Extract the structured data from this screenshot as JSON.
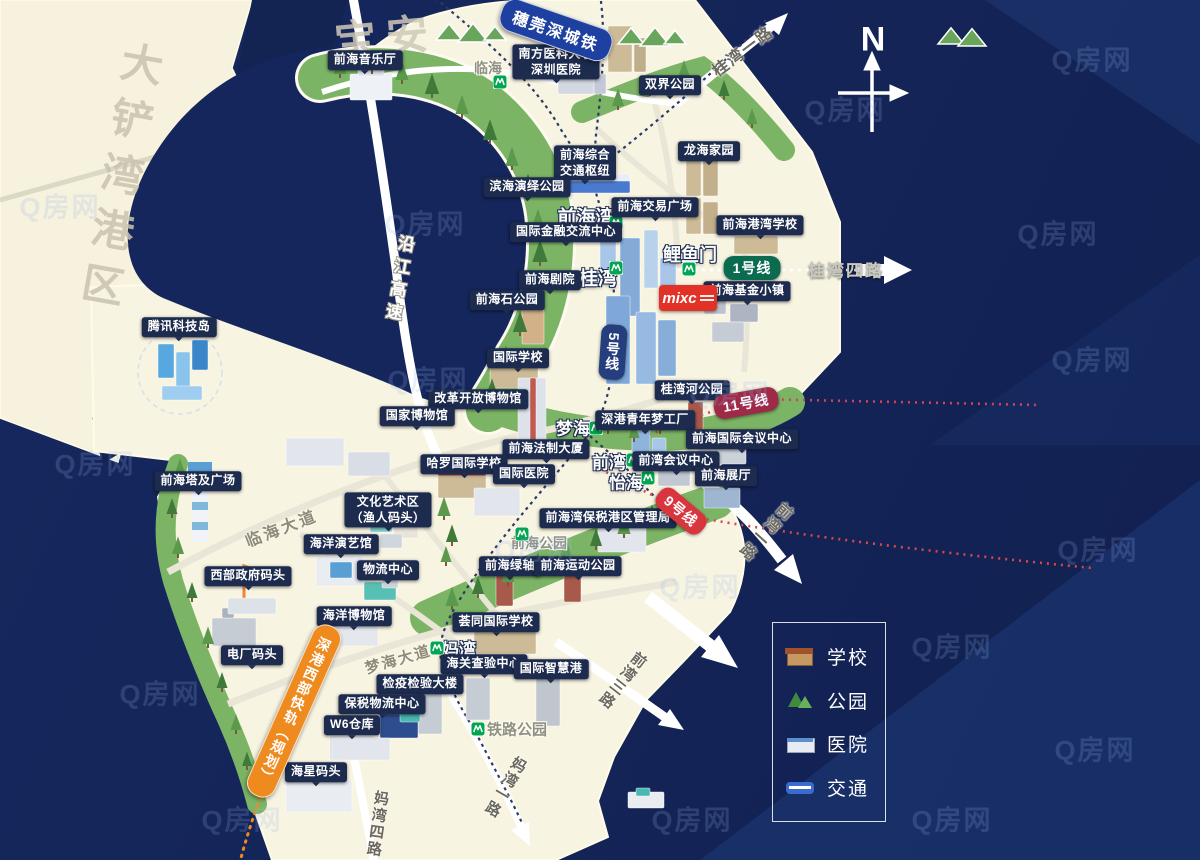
{
  "watermark": {
    "text": "Q房网",
    "positions": [
      [
        60,
        205
      ],
      [
        425,
        222
      ],
      [
        845,
        108
      ],
      [
        1092,
        58
      ],
      [
        1058,
        232
      ],
      [
        428,
        378
      ],
      [
        95,
        462
      ],
      [
        730,
        392
      ],
      [
        1092,
        358
      ],
      [
        535,
        548
      ],
      [
        1098,
        548
      ],
      [
        160,
        692
      ],
      [
        700,
        585
      ],
      [
        952,
        645
      ],
      [
        242,
        818
      ],
      [
        692,
        818
      ],
      [
        952,
        818
      ],
      [
        1095,
        748
      ]
    ]
  },
  "compass": {
    "label": "N"
  },
  "ghosts": [
    {
      "name": "ghost-dachanwan-port",
      "text": "大铲湾港区",
      "x": 112,
      "y": 168,
      "vertical": true,
      "rot": 10,
      "size": 42,
      "ls": 14,
      "color": "#c9c3b0"
    },
    {
      "name": "ghost-baoan",
      "text": "宝安",
      "x": 380,
      "y": 25,
      "vertical": false,
      "rot": -5,
      "size": 42,
      "ls": 10,
      "color": "#cfc9b8"
    }
  ],
  "banners": [
    {
      "name": "intercity-rail-banner",
      "text": "穗莞深城铁",
      "x": 556,
      "y": 30,
      "rot": 19,
      "color": "#1e40a0",
      "vertical": false,
      "size": 16
    },
    {
      "name": "west-express-rail-banner",
      "text": "深港西部快轨（规划）",
      "x": 294,
      "y": 711,
      "rot": 24,
      "color": "#ef8a1f",
      "vertical": true,
      "size": 14
    }
  ],
  "metro_lines": [
    {
      "name": "metro-line-1-badge",
      "label": "1号线",
      "x": 752,
      "y": 268,
      "color": "#0a6b50",
      "rot": 0,
      "vertical": false
    },
    {
      "name": "metro-line-5-badge",
      "label": "5号线",
      "x": 613,
      "y": 352,
      "color": "#253f7e",
      "rot": 4,
      "vertical": true
    },
    {
      "name": "metro-line-11-badge",
      "label": "11号线",
      "x": 746,
      "y": 403,
      "color": "#9e2a47",
      "rot": -10,
      "vertical": false
    },
    {
      "name": "metro-line-9-badge",
      "label": "9号线",
      "x": 681,
      "y": 511,
      "color": "#d9353f",
      "rot": 40,
      "vertical": false
    }
  ],
  "roads": [
    {
      "name": "road-yanjiang-expressway",
      "text": "沿江高速",
      "x": 398,
      "y": 280,
      "vertical": true,
      "rot": 10,
      "cls": "white-outline",
      "size": 17,
      "ls": 6
    },
    {
      "name": "road-guiwan-1",
      "text": "桂湾一路",
      "x": 742,
      "y": 50,
      "vertical": false,
      "rot": -37,
      "cls": "dark",
      "size": 16,
      "ls": 2
    },
    {
      "name": "road-guiwan-4",
      "text": "桂湾四路",
      "x": 846,
      "y": 269,
      "vertical": false,
      "rot": 0,
      "cls": "light",
      "size": 17,
      "ls": 2
    },
    {
      "name": "road-qianwan-1",
      "text": "前湾一路",
      "x": 764,
      "y": 530,
      "vertical": true,
      "rot": 42,
      "cls": "dark",
      "size": 16,
      "ls": 2
    },
    {
      "name": "road-qianwan-3",
      "text": "前湾三路",
      "x": 622,
      "y": 680,
      "vertical": true,
      "rot": 38,
      "cls": "dark",
      "size": 15,
      "ls": 2
    },
    {
      "name": "road-linhai-avenue",
      "text": "临海大道",
      "x": 281,
      "y": 527,
      "vertical": false,
      "rot": -21,
      "cls": "gray",
      "size": 16,
      "ls": 3
    },
    {
      "name": "road-menghai-avenue",
      "text": "梦海大道",
      "x": 398,
      "y": 659,
      "vertical": false,
      "rot": -16,
      "cls": "gray",
      "size": 15,
      "ls": 2
    },
    {
      "name": "road-mawan-1",
      "text": "妈湾一路",
      "x": 505,
      "y": 787,
      "vertical": true,
      "rot": 30,
      "cls": "dark",
      "size": 15,
      "ls": 2
    },
    {
      "name": "road-mawan-4",
      "text": "妈湾四路",
      "x": 377,
      "y": 824,
      "vertical": true,
      "rot": 8,
      "cls": "dark",
      "size": 15,
      "ls": 2
    }
  ],
  "stations": [
    {
      "name": "station-linhai",
      "label": "临海",
      "x": 488,
      "y": 68,
      "size": 14,
      "cls": "minor",
      "icon": [
        500,
        82
      ]
    },
    {
      "name": "station-qianhaiwan",
      "label": "前海湾",
      "x": 586,
      "y": 216,
      "size": 19,
      "cls": "major",
      "icon": [
        616,
        223
      ]
    },
    {
      "name": "station-guiwan",
      "label": "桂湾",
      "x": 598,
      "y": 277,
      "size": 19,
      "cls": "major",
      "icon": [
        616,
        268
      ]
    },
    {
      "name": "station-liyumen",
      "label": "鲤鱼门",
      "x": 690,
      "y": 254,
      "size": 18,
      "cls": "major",
      "icon": [
        689,
        269
      ]
    },
    {
      "name": "station-menghai",
      "label": "梦海",
      "x": 573,
      "y": 427,
      "size": 17,
      "cls": "major",
      "icon": [
        596,
        428
      ]
    },
    {
      "name": "station-qianwan",
      "label": "前湾",
      "x": 609,
      "y": 461,
      "size": 17,
      "cls": "major",
      "icon": [
        633,
        460
      ]
    },
    {
      "name": "station-yihai",
      "label": "怡海",
      "x": 626,
      "y": 481,
      "size": 17,
      "cls": "major",
      "icon": [
        648,
        478
      ]
    },
    {
      "name": "station-mawan",
      "label": "妈湾",
      "x": 459,
      "y": 648,
      "size": 17,
      "cls": "major",
      "icon": [
        437,
        648
      ]
    },
    {
      "name": "station-qianhai-park",
      "label": "前海公园",
      "x": 539,
      "y": 543,
      "size": 14,
      "cls": "minor",
      "icon": [
        522,
        534
      ]
    },
    {
      "name": "station-railway-park",
      "label": "铁路公园",
      "x": 517,
      "y": 729,
      "size": 15,
      "cls": "minor",
      "icon": [
        478,
        729
      ]
    }
  ],
  "pois": [
    {
      "name": "poi-qianhai-concert-hall",
      "text": "前海音乐厅",
      "x": 365,
      "y": 60
    },
    {
      "name": "poi-southern-medical-univ-hospital",
      "text": "南方医科大学\n深圳医院",
      "x": 556,
      "y": 62
    },
    {
      "name": "poi-shuangjie-park",
      "text": "双界公园",
      "x": 670,
      "y": 85
    },
    {
      "name": "poi-longhai-homeland",
      "text": "龙海家园",
      "x": 709,
      "y": 151
    },
    {
      "name": "poi-qianhai-transport-hub",
      "text": "前海综合\n交通枢纽",
      "x": 585,
      "y": 163
    },
    {
      "name": "poi-binhai-performance-park",
      "text": "滨海演绎公园",
      "x": 527,
      "y": 187
    },
    {
      "name": "poi-intl-finance-exchange-center",
      "text": "国际金融交流中心",
      "x": 566,
      "y": 232
    },
    {
      "name": "poi-qianhai-exchange-plaza",
      "text": "前海交易广场",
      "x": 655,
      "y": 207
    },
    {
      "name": "poi-qianhai-gangwan-school",
      "text": "前海港湾学校",
      "x": 760,
      "y": 225
    },
    {
      "name": "poi-qianhai-theater",
      "text": "前海剧院",
      "x": 550,
      "y": 280
    },
    {
      "name": "poi-qianhai-stone-park",
      "text": "前海石公园",
      "x": 507,
      "y": 300
    },
    {
      "name": "poi-qianhai-fund-town",
      "text": "前海基金小镇",
      "x": 747,
      "y": 291
    },
    {
      "name": "poi-tencent-tech-island",
      "text": "腾讯科技岛",
      "x": 179,
      "y": 327
    },
    {
      "name": "poi-international-school",
      "text": "国际学校",
      "x": 518,
      "y": 358
    },
    {
      "name": "poi-reform-opening-museum",
      "text": "改革开放博物馆",
      "x": 478,
      "y": 399
    },
    {
      "name": "poi-national-museum",
      "text": "国家博物馆",
      "x": 417,
      "y": 416
    },
    {
      "name": "poi-guiwan-river-park",
      "text": "桂湾河公园",
      "x": 692,
      "y": 390
    },
    {
      "name": "poi-szhk-youth-dream-factory",
      "text": "深港青年梦工厂",
      "x": 645,
      "y": 420
    },
    {
      "name": "poi-qianhai-law-tower",
      "text": "前海法制大厦",
      "x": 546,
      "y": 449
    },
    {
      "name": "poi-harrow-international-school",
      "text": "哈罗国际学校",
      "x": 464,
      "y": 464
    },
    {
      "name": "poi-international-hospital",
      "text": "国际医院",
      "x": 524,
      "y": 474
    },
    {
      "name": "poi-qianhai-intl-convention-center",
      "text": "前海国际会议中心",
      "x": 742,
      "y": 439
    },
    {
      "name": "poi-qianwan-convention-center",
      "text": "前湾会议中心",
      "x": 676,
      "y": 461
    },
    {
      "name": "poi-qianhai-exhibition-hall",
      "text": "前海展厅",
      "x": 726,
      "y": 476
    },
    {
      "name": "poi-qianhai-tower-plaza",
      "text": "前海塔及广场",
      "x": 198,
      "y": 481
    },
    {
      "name": "poi-culture-art-district",
      "text": "文化艺术区\n（渔人码头）",
      "x": 388,
      "y": 510
    },
    {
      "name": "poi-bonded-port-admin",
      "text": "前海湾保税港区管理局",
      "x": 608,
      "y": 518
    },
    {
      "name": "poi-ocean-performance-hall",
      "text": "海洋演艺馆",
      "x": 341,
      "y": 544
    },
    {
      "name": "poi-qianhai-green-axis",
      "text": "前海绿轴",
      "x": 510,
      "y": 566
    },
    {
      "name": "poi-qianhai-sports-park",
      "text": "前海运动公园",
      "x": 578,
      "y": 566
    },
    {
      "name": "poi-logistics-center",
      "text": "物流中心",
      "x": 388,
      "y": 570
    },
    {
      "name": "poi-west-government-wharf",
      "text": "西部政府码头",
      "x": 248,
      "y": 576
    },
    {
      "name": "poi-ocean-museum",
      "text": "海洋博物馆",
      "x": 354,
      "y": 616
    },
    {
      "name": "poi-whittle-school",
      "text": "荟同国际学校",
      "x": 496,
      "y": 622
    },
    {
      "name": "poi-power-plant-wharf",
      "text": "电厂码头",
      "x": 252,
      "y": 655
    },
    {
      "name": "poi-customs-inspection-center",
      "text": "海关查验中心",
      "x": 484,
      "y": 664
    },
    {
      "name": "poi-intl-smart-port",
      "text": "国际智慧港",
      "x": 551,
      "y": 669
    },
    {
      "name": "poi-quarantine-building",
      "text": "检疫检验大楼",
      "x": 420,
      "y": 684
    },
    {
      "name": "poi-bonded-logistics-center",
      "text": "保税物流中心",
      "x": 382,
      "y": 704
    },
    {
      "name": "poi-w6-warehouse",
      "text": "W6仓库",
      "x": 352,
      "y": 725
    },
    {
      "name": "poi-haixing-wharf",
      "text": "海星码头",
      "x": 316,
      "y": 772
    }
  ],
  "mixc": {
    "label": "mixc"
  },
  "legend": {
    "items": [
      {
        "name": "legend-school",
        "label": "学校",
        "icon": "school"
      },
      {
        "name": "legend-park",
        "label": "公园",
        "icon": "park"
      },
      {
        "name": "legend-hospital",
        "label": "医院",
        "icon": "hospital"
      },
      {
        "name": "legend-transit",
        "label": "交通",
        "icon": "transit"
      }
    ]
  }
}
